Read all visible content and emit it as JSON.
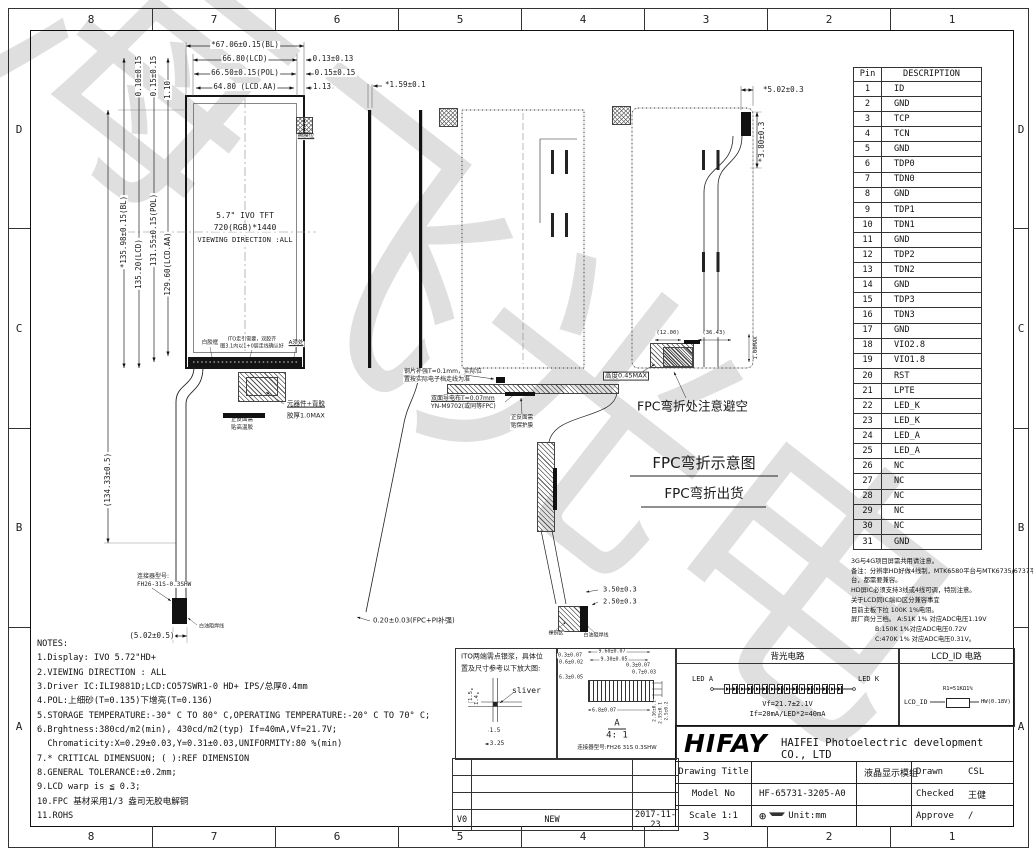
{
  "sheet": {
    "grid_cols": [
      "8",
      "7",
      "6",
      "5",
      "4",
      "3",
      "2",
      "1"
    ],
    "grid_rows": [
      "D",
      "C",
      "B",
      "A"
    ],
    "watermark": "海飞光电"
  },
  "pin_table": {
    "headers": [
      "Pin",
      "DESCRIPTION"
    ],
    "rows": [
      [
        "1",
        "ID"
      ],
      [
        "2",
        "GND"
      ],
      [
        "3",
        "TCP"
      ],
      [
        "4",
        "TCN"
      ],
      [
        "5",
        "GND"
      ],
      [
        "6",
        "TDP0"
      ],
      [
        "7",
        "TDN0"
      ],
      [
        "8",
        "GND"
      ],
      [
        "9",
        "TDP1"
      ],
      [
        "10",
        "TDN1"
      ],
      [
        "11",
        "GND"
      ],
      [
        "12",
        "TDP2"
      ],
      [
        "13",
        "TDN2"
      ],
      [
        "14",
        "GND"
      ],
      [
        "15",
        "TDP3"
      ],
      [
        "16",
        "TDN3"
      ],
      [
        "17",
        "GND"
      ],
      [
        "18",
        "VIO2.8"
      ],
      [
        "19",
        "VIO1.8"
      ],
      [
        "20",
        "RST"
      ],
      [
        "21",
        "LPTE"
      ],
      [
        "22",
        "LED_K"
      ],
      [
        "23",
        "LED_K"
      ],
      [
        "24",
        "LED_A"
      ],
      [
        "25",
        "LED_A"
      ],
      [
        "26",
        "NC"
      ],
      [
        "27",
        "NC"
      ],
      [
        "28",
        "NC"
      ],
      [
        "29",
        "NC"
      ],
      [
        "30",
        "NC"
      ],
      [
        "31",
        "GND"
      ]
    ]
  },
  "id_note_lines": [
    "3G与4G项目屏需共用请注意。",
    "备注：分辨率HD好做4线制，MTK6580平台与MTK6735/6737平",
    "台，都需要兼容。",
    "HD屏IC必须支持3线或4线可调，特别注意。",
    "关于LCD同IC端ID区分兼容事宜",
    "目前主板下拉 100K 1%电阻。",
    "屏厂商分三档。 A:51K 1% 对应ADC电压1.19V",
    "            B:150K 1%对应ADC电压0.72V",
    "            C:470K 1% 对应ADC电压0.31V。"
  ],
  "notes_lines": [
    "NOTES:",
    "1.Display: IVO 5.72\"HD+",
    "2.VIEWING DIRECTION : ALL",
    "3.Driver IC:ILI9881D;LCD:CO57SWR1-0 HD+ IPS/总厚0.4mm",
    "4.POL:上细砂(T=0.135)下增亮(T=0.136)",
    "5.STORAGE TEMPERATURE:-30° C TO 80° C,OPERATING TEMPERATURE:-20° C TO 70° C;",
    "6.Brghtness:380cd/m2(min), 430cd/m2(typ) If=40mA,Vf=21.7V;",
    "  Chromaticity:X=0.29±0.03,Y=0.31±0.03,UNIFORMITY:80 %(min)",
    "7.* CRITICAL DIMENSUON; ( ):REF DIMENSION",
    "8.GENERAL TOLERANCE:±0.2mm;",
    "9.LCD warp is ≦ 0.3;",
    "10.FPC 基材采用1/3 盎司无胶电解铜",
    "11.ROHS"
  ],
  "circuits": {
    "backlight": {
      "title": "背光电路",
      "led_a": "LED A",
      "led_k": "LED K",
      "led_count": 16,
      "vf": "Vf=21.7±2.1V",
      "if": "If=20mA/LED*2=40mA"
    },
    "lcd_id": {
      "title": "LCD_ID 电路",
      "signal": "LCD_ID",
      "resistor": "R1=51KΩ1%",
      "output": "HW(0.18V)"
    }
  },
  "title_block": {
    "logo": "HIFAY",
    "company": "HAIFEI Photoelectric development CO., LTD",
    "drawing_title_label": "Drawing Title",
    "drawing_title": "液晶显示模组",
    "model_label": "Model No",
    "model": "HF-65731-3205-A0",
    "scale_label": "Scale 1:1",
    "unit": "Unit:mm",
    "drawn_label": "Drawn",
    "drawn": "CSL",
    "checked_label": "Checked",
    "checked": "王健",
    "approve_label": "Approve",
    "approve": "/"
  },
  "revision": {
    "rows": [
      [
        "",
        "",
        ""
      ],
      [
        "",
        "",
        ""
      ],
      [
        "",
        "",
        ""
      ],
      [
        "V0",
        "NEW",
        "2017-11-23"
      ]
    ]
  },
  "annotations": [
    {
      "t": "*67.06±0.15(BL)",
      "x": 245,
      "y": 45,
      "a": "c",
      "n": "dim-width-bl"
    },
    {
      "t": "66.80(LCD)",
      "x": 245,
      "y": 59,
      "a": "c",
      "n": "dim-width-lcd"
    },
    {
      "t": "66.50±0.15(POL)",
      "x": 245,
      "y": 73,
      "a": "c",
      "n": "dim-width-pol"
    },
    {
      "t": "64.80 (LCD.AA)",
      "x": 245,
      "y": 87,
      "a": "c",
      "n": "dim-width-aa"
    },
    {
      "t": "0.13±0.13",
      "x": 333,
      "y": 59,
      "a": "c"
    },
    {
      "t": "0.15±0.15",
      "x": 335,
      "y": 73,
      "a": "c"
    },
    {
      "t": "1.13",
      "x": 322,
      "y": 87,
      "a": "c"
    },
    {
      "t": "*1.59±0.1",
      "x": 384,
      "y": 85,
      "a": "l",
      "n": "dim-thickness"
    },
    {
      "t": "0.10±0.15",
      "x": 139,
      "y": 76,
      "rot": 1
    },
    {
      "t": "0.15±0.15",
      "x": 154,
      "y": 76,
      "rot": 1
    },
    {
      "t": "1.10",
      "x": 168,
      "y": 90,
      "rot": 1
    },
    {
      "t": "*135.98±0.15(BL)",
      "x": 124,
      "y": 232,
      "rot": 1,
      "n": "dim-height-bl"
    },
    {
      "t": "135.20(LCD)",
      "x": 139,
      "y": 264,
      "rot": 1,
      "n": "dim-height-lcd"
    },
    {
      "t": "131.55±0.15(POL)",
      "x": 154,
      "y": 230,
      "rot": 1,
      "n": "dim-height-pol"
    },
    {
      "t": "129.60(LCD.AA)",
      "x": 168,
      "y": 264,
      "rot": 1,
      "n": "dim-height-aa"
    },
    {
      "t": "(134.33±0.5)",
      "x": 108,
      "y": 480,
      "rot": 1,
      "n": "dim-fpc-length"
    },
    {
      "t": "(5.02±0.5)",
      "x": 152,
      "y": 636,
      "a": "c"
    },
    {
      "t": "5.7\" IVO TFT",
      "x": 245,
      "y": 216,
      "a": "c",
      "fs": 8,
      "n": "panel-size"
    },
    {
      "t": "720(RGB)*1440",
      "x": 245,
      "y": 228,
      "a": "c",
      "fs": 8,
      "n": "panel-resolution"
    },
    {
      "t": "VIEWING DIRECTION :ALL",
      "x": 245,
      "y": 240,
      "a": "c",
      "fs": 7.2,
      "n": "viewing-direction"
    },
    {
      "t": "白胶框",
      "x": 210,
      "y": 344,
      "a": "c",
      "fs": 5.5
    },
    {
      "t": "ITO走引需要，双胶齐",
      "x": 252,
      "y": 340,
      "a": "c",
      "fs": 5
    },
    {
      "t": "图3.1内以1+0层走线确认好",
      "x": 252,
      "y": 347,
      "a": "c",
      "fs": 5
    },
    {
      "t": "A须处",
      "x": 296,
      "y": 344,
      "a": "c",
      "fs": 5.5,
      "ul": 1
    },
    {
      "t": "撕膜位",
      "x": 306,
      "y": 137,
      "a": "c",
      "fs": 5.5,
      "ul": 1
    },
    {
      "t": "元器件+背胶",
      "x": 286,
      "y": 404,
      "a": "l",
      "fs": 6.5,
      "ul": 1
    },
    {
      "t": "胶厚1.0MAX",
      "x": 286,
      "y": 416,
      "a": "l",
      "fs": 6.5
    },
    {
      "t": "正反面需",
      "x": 242,
      "y": 421,
      "a": "c",
      "fs": 5.5
    },
    {
      "t": "贴高温胶",
      "x": 242,
      "y": 429,
      "a": "c",
      "fs": 5.5
    },
    {
      "t": "连接器型号:",
      "x": 136,
      "y": 577,
      "a": "l",
      "fs": 6
    },
    {
      "t": "FH26-31S-0.3SHW",
      "x": 136,
      "y": 585,
      "a": "l",
      "fs": 6,
      "n": "fpc-connector-model"
    },
    {
      "t": "白油阻焊线",
      "x": 198,
      "y": 627,
      "a": "l",
      "fs": 5
    },
    {
      "t": "钢片补强T=0.1mm，实际位",
      "x": 403,
      "y": 372,
      "a": "l",
      "fs": 6
    },
    {
      "t": "置按实际电子档走线为准",
      "x": 403,
      "y": 380,
      "a": "l",
      "fs": 6
    },
    {
      "t": "双面导电布T=0.07mm",
      "x": 430,
      "y": 399,
      "a": "l",
      "fs": 6,
      "ul": 1
    },
    {
      "t": "YN-M9702(或同等FPC)",
      "x": 430,
      "y": 407,
      "a": "l",
      "fs": 6
    },
    {
      "t": "正反面需",
      "x": 522,
      "y": 419,
      "a": "c",
      "fs": 5.5
    },
    {
      "t": "贴保护膜",
      "x": 522,
      "y": 427,
      "a": "c",
      "fs": 5.5
    },
    {
      "t": "0.20±0.03(FPC+PI补强)",
      "x": 372,
      "y": 621,
      "a": "l",
      "fs": 7
    },
    {
      "t": "3.50±0.3",
      "x": 602,
      "y": 590,
      "a": "l",
      "fs": 7
    },
    {
      "t": "2.50±0.3",
      "x": 602,
      "y": 602,
      "a": "l",
      "fs": 7
    },
    {
      "t": "裸铜区",
      "x": 556,
      "y": 634,
      "a": "c",
      "fs": 5
    },
    {
      "t": "白油阻焊线",
      "x": 596,
      "y": 636,
      "a": "c",
      "fs": 5
    },
    {
      "t": "*5.02±0.3",
      "x": 762,
      "y": 90,
      "a": "l"
    },
    {
      "t": "*3.80±0.3",
      "x": 762,
      "y": 142,
      "rot": 1
    },
    {
      "t": "(12.00)",
      "x": 668,
      "y": 334,
      "a": "c",
      "fs": 5.5
    },
    {
      "t": "(36.43)",
      "x": 714,
      "y": 334,
      "a": "c",
      "fs": 5.5
    },
    {
      "t": "1.00MAX",
      "x": 757,
      "y": 348,
      "rot": 1,
      "fs": 5.5
    },
    {
      "t": "高度0.45MAX",
      "x": 603,
      "y": 376,
      "a": "l",
      "fs": 6.5,
      "boxed": 1
    },
    {
      "t": "FPC弯折处注意避空",
      "x": 637,
      "y": 406,
      "a": "l",
      "fs": 12.5,
      "nobg": 1,
      "n": "fpc-bend-warning"
    },
    {
      "t": "FPC弯折示意图",
      "x": 704,
      "y": 464,
      "a": "c",
      "fs": 15,
      "nobg": 1,
      "n": "fpc-bend-diagram-title"
    },
    {
      "t": "FPC弯折出货",
      "x": 704,
      "y": 494,
      "a": "c",
      "fs": 13.5,
      "nobg": 1,
      "n": "fpc-bend-shipping"
    },
    {
      "t": "ITO两端需点银浆，具体位",
      "x": 461,
      "y": 657,
      "a": "l",
      "fs": 7,
      "nobg": 1
    },
    {
      "t": "置及尺寸参考以下放大图:",
      "x": 461,
      "y": 669,
      "a": "l",
      "fs": 7,
      "nobg": 1
    },
    {
      "t": "sliver",
      "x": 512,
      "y": 691,
      "a": "l",
      "fs": 8,
      "nobg": 1,
      "n": "sliver-label"
    },
    {
      "t": "1.5",
      "x": 495,
      "y": 731,
      "a": "c",
      "fs": 6
    },
    {
      "t": "3.25",
      "x": 497,
      "y": 744,
      "a": "c",
      "fs": 6
    },
    {
      "t": "1.5",
      "x": 472,
      "y": 696,
      "rot": 1,
      "fs": 5.5
    },
    {
      "t": "1.4",
      "x": 478,
      "y": 700,
      "rot": 1,
      "fs": 5.5
    },
    {
      "t": "9.60±0.07",
      "x": 612,
      "y": 652,
      "a": "c",
      "fs": 5
    },
    {
      "t": "9.30±0.05",
      "x": 614,
      "y": 660,
      "a": "c",
      "fs": 5
    },
    {
      "t": "0.3±0.07",
      "x": 570,
      "y": 656,
      "a": "c",
      "fs": 5
    },
    {
      "t": "0.6±0.02",
      "x": 571,
      "y": 663,
      "a": "c",
      "fs": 5
    },
    {
      "t": "0.3±0.07",
      "x": 638,
      "y": 666,
      "a": "c",
      "fs": 5
    },
    {
      "t": "0.7±0.03",
      "x": 644,
      "y": 673,
      "a": "c",
      "fs": 5
    },
    {
      "t": "6.3±0.05",
      "x": 571,
      "y": 678,
      "a": "c",
      "fs": 5
    },
    {
      "t": "6.8±0.07",
      "x": 604,
      "y": 711,
      "a": "c",
      "fs": 5
    },
    {
      "t": "2.16±0.1",
      "x": 656,
      "y": 711,
      "rot": 1,
      "fs": 4.5
    },
    {
      "t": "2.35±0.1",
      "x": 662,
      "y": 713,
      "rot": 1,
      "fs": 4.5
    },
    {
      "t": "2.5±0.2",
      "x": 668,
      "y": 711,
      "rot": 1,
      "fs": 4.5
    },
    {
      "t": "A",
      "x": 617,
      "y": 724,
      "a": "c",
      "fs": 9,
      "nobg": 1,
      "n": "section-a-label"
    },
    {
      "t": "4: 1",
      "x": 617,
      "y": 736,
      "a": "c",
      "fs": 9,
      "nobg": 1,
      "n": "detail-scale"
    },
    {
      "t": "连接器型号:FH26 31S 0.3SHW",
      "x": 617,
      "y": 749,
      "a": "c",
      "fs": 5.5,
      "nobg": 1,
      "n": "connector-model"
    }
  ]
}
